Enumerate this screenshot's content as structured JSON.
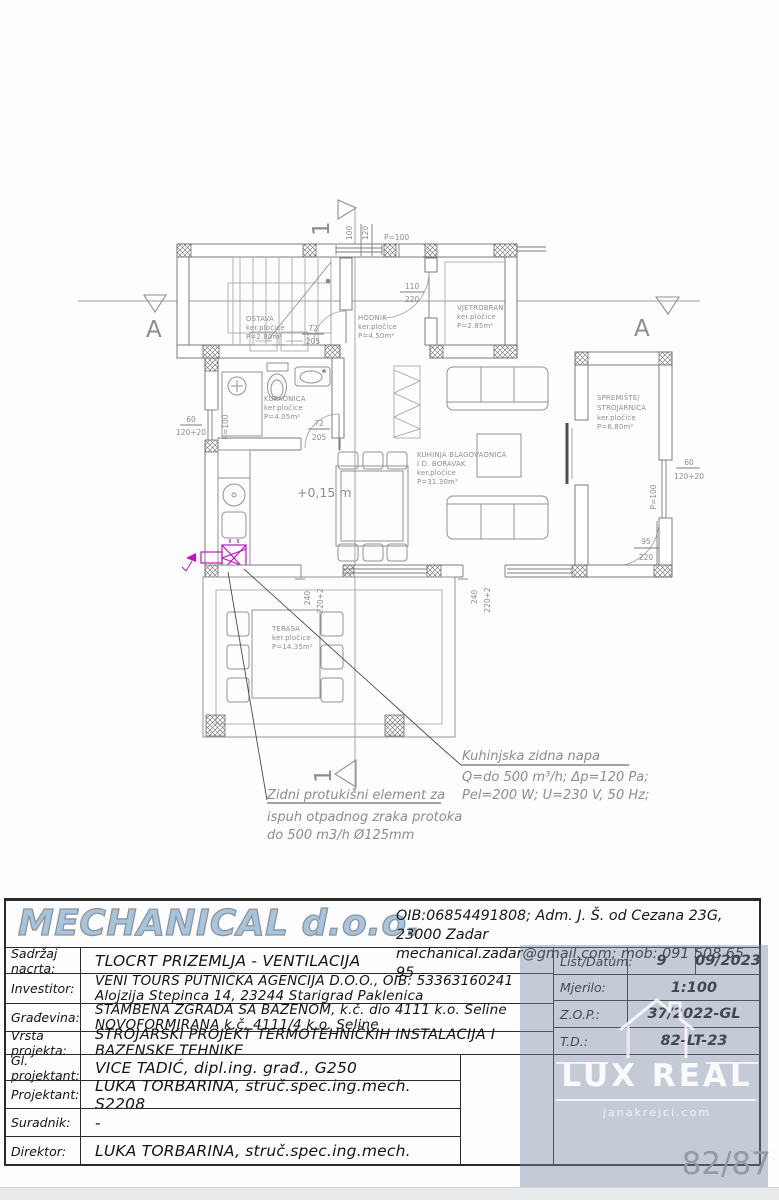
{
  "plan": {
    "level_label": "+0,15 m",
    "section_marker_a": "A",
    "section_marker_1": "1",
    "rooms": {
      "ostava": {
        "name": "OSTAVA",
        "tile": "ker.pločice",
        "area": "P=2.80m²"
      },
      "hodnik": {
        "name": "HODNIK",
        "tile": "ker.pločice",
        "area": "P=4.50m²"
      },
      "vjetrobran": {
        "name": "VJETROBRAN",
        "tile": "ker.pločice",
        "area": "P=2.85m²"
      },
      "kupaonica": {
        "name": "KUPAONICA",
        "tile": "ker.pločice",
        "area": "P=4.05m²"
      },
      "kuhinja": {
        "name": "KUHINJA BLAGOVAONICA",
        "name2": "I D. BORAVAK",
        "tile": "ker.pločice",
        "area": "P=31.30m²"
      },
      "spremiste": {
        "name": "SPREMIŠTE/",
        "name2": "STROJARNICA",
        "tile": "ker.pločice",
        "area": "P=6.80m²"
      },
      "terasa": {
        "name": "TERASA",
        "tile": "ker.pločice",
        "area": "P=14.35m²"
      }
    },
    "dims": {
      "top_100": "100",
      "top_120": "120",
      "top_p100": "P=100",
      "hodnik_door_w": "110",
      "hodnik_door_h": "220",
      "ostava_door_w": "72",
      "ostava_door_h": "205",
      "kupaonica_door_w": "72",
      "kupaonica_door_h": "205",
      "left_60": "60",
      "left_120": "120+20",
      "left_p100": "P=100",
      "right_60": "60",
      "right_120": "120+20",
      "right_p100": "P=100",
      "spremiste_door_w": "95",
      "spremiste_door_h": "220",
      "door1_240": "240",
      "door1_220": "220+2",
      "door2_240": "240",
      "door2_220": "220+2"
    },
    "annotations": {
      "napa_title": "Kuhinjska zidna napa",
      "napa_line1": "Q=do 500 m³/h; Δp=120 Pa;",
      "napa_line2": "Pel=200 W; U=230 V, 50 Hz;",
      "zidni_line1": "Zidni protukišni element za",
      "zidni_line2": "ispuh otpadnog zraka protoka",
      "zidni_line3": "do 500 m3/h Ø125mm"
    }
  },
  "titleblock": {
    "company_name": "MECHANICAL d.o.o.",
    "company_line1": "OIB:06854491808; Adm. J. Š. od Cezana 23G, 23000 Zadar",
    "company_line2": "mechanical.zadar@gmail.com; mob: 091 508 65 95",
    "rows": [
      {
        "label": "Sadržaj nacrta:",
        "value": "TLOCRT PRIZEMLJA - VENTILACIJA"
      },
      {
        "label": "Investitor:",
        "value": "VENI TOURS PUTNIČKA AGENCIJA D.O.O., OIB: 53363160241",
        "value2": "Alojzija Stepinca 14, 23244 Starigrad Paklenica"
      },
      {
        "label": "Građevina:",
        "value": "STAMBENA ZGRADA SA BAZENOM, k.č. dio 4111 k.o. Seline",
        "value2": "NOVOFORMIRANA  k.č. 4111/4 k.o. Seline"
      },
      {
        "label": "Vrsta projekta:",
        "value": "STROJARSKI PROJEKT TERMOTEHNIČKIH INSTALACIJA I BAZENSKE TEHNIKE"
      },
      {
        "label": "Gl. projektant:",
        "value": "VICE TADIĆ, dipl.ing. građ., G250"
      },
      {
        "label": "Projektant:",
        "value": "LUKA TORBARINA, struč.spec.ing.mech. S2208"
      },
      {
        "label": "Suradnik:",
        "value": "-"
      },
      {
        "label": "Direktor:",
        "value": "LUKA TORBARINA, struč.spec.ing.mech."
      }
    ],
    "meta": [
      {
        "label": "List/Datum:",
        "value1": "9",
        "value2": "09/2023"
      },
      {
        "label": "Mjerilo:",
        "value1": "1:100"
      },
      {
        "label": "Z.O.P.:",
        "value1": "37/2022-GL"
      },
      {
        "label": "T.D.:",
        "value1": "82-LT-23"
      }
    ]
  },
  "watermark": {
    "title": "LUX REAL",
    "subtitle": "janakrejci.com"
  },
  "page_number": "82/87",
  "colors": {
    "magenta": "#c410c4",
    "logo_blue": "#a6c4de",
    "watermark_bg": "#8f9cb0"
  }
}
